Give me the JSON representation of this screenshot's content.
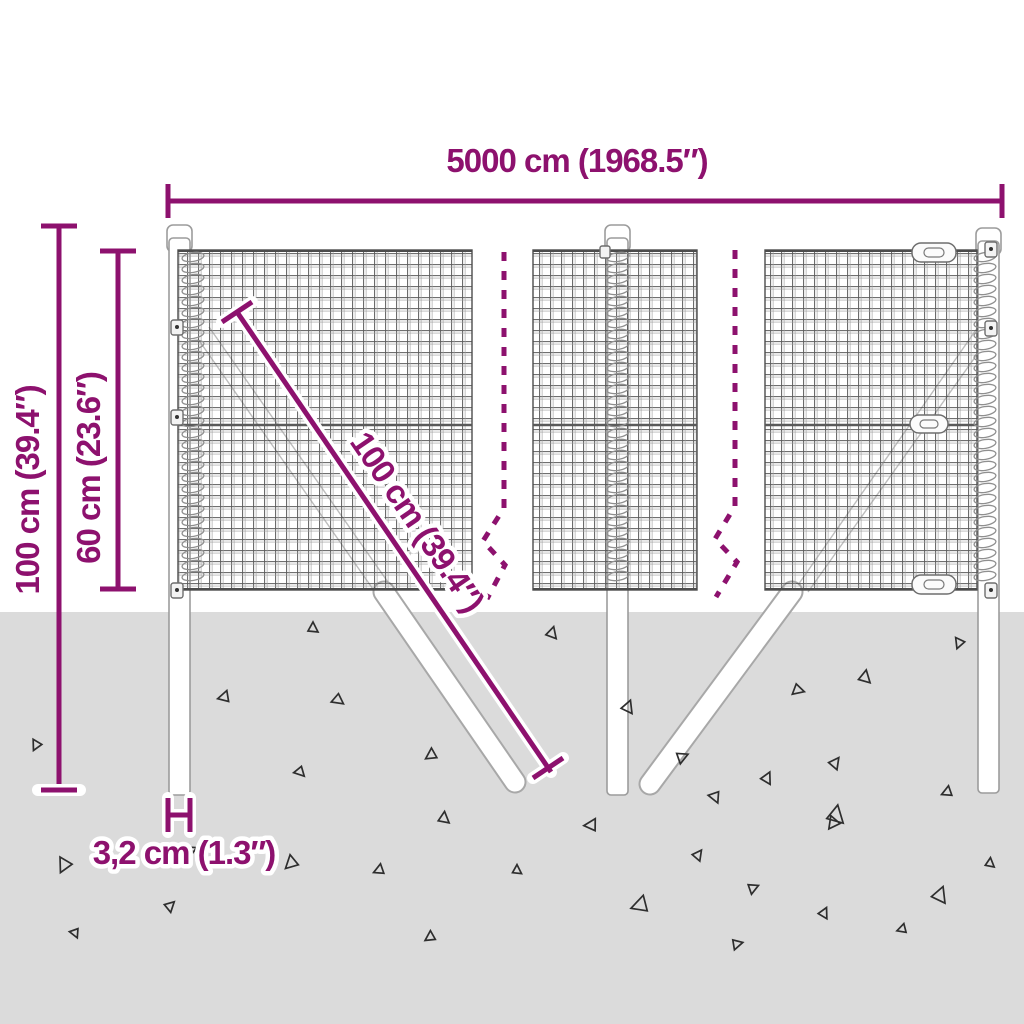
{
  "diagram": {
    "subject": "wire-mesh-fence-with-posts-and-ground-anchors",
    "dimensions": {
      "width": {
        "label": "5000 cm (1968.5″)"
      },
      "total_height": {
        "label": "100 cm (39.4″)"
      },
      "mesh_height": {
        "label": "60 cm (23.6″)"
      },
      "anchor_length": {
        "label": "100 cm (39.4″)"
      },
      "post_width": {
        "label": "3,2 cm (1.3″)"
      }
    }
  },
  "colors": {
    "dimension": "#8d116e",
    "ground": "#dbdbdb",
    "mesh_wire": "#3f3f3f",
    "structure_outline": "#9c9c9c"
  },
  "decor": {
    "triangles": [
      [
        313,
        628,
        10,
        0
      ],
      [
        552,
        633,
        11,
        15
      ],
      [
        959,
        643,
        10,
        200
      ],
      [
        865,
        677,
        12,
        10
      ],
      [
        798,
        690,
        11,
        105
      ],
      [
        628,
        707,
        12,
        20
      ],
      [
        224,
        697,
        11,
        255
      ],
      [
        338,
        700,
        11,
        125
      ],
      [
        36,
        745,
        10,
        205
      ],
      [
        431,
        755,
        11,
        235
      ],
      [
        682,
        757,
        11,
        65
      ],
      [
        300,
        772,
        10,
        135
      ],
      [
        767,
        778,
        11,
        25
      ],
      [
        835,
        763,
        11,
        35
      ],
      [
        947,
        792,
        10,
        245
      ],
      [
        715,
        797,
        11,
        155
      ],
      [
        836,
        815,
        17,
        10
      ],
      [
        444,
        818,
        11,
        5
      ],
      [
        591,
        825,
        12,
        265
      ],
      [
        64,
        865,
        14,
        205
      ],
      [
        291,
        863,
        13,
        225
      ],
      [
        170,
        906,
        10,
        45
      ],
      [
        75,
        933,
        9,
        155
      ],
      [
        379,
        870,
        10,
        245
      ],
      [
        430,
        937,
        10,
        235
      ],
      [
        517,
        870,
        9,
        0
      ],
      [
        640,
        905,
        16,
        250
      ],
      [
        698,
        855,
        10,
        35
      ],
      [
        753,
        888,
        10,
        65
      ],
      [
        824,
        913,
        10,
        25
      ],
      [
        902,
        929,
        9,
        250
      ],
      [
        940,
        895,
        15,
        20
      ],
      [
        990,
        863,
        9,
        5
      ],
      [
        737,
        944,
        10,
        75
      ],
      [
        833,
        823,
        12,
        215
      ],
      [
        193,
        849,
        6,
        300
      ]
    ],
    "coils": [
      {
        "x": 193,
        "y1": 257,
        "y2": 584
      },
      {
        "x": 618,
        "y1": 257,
        "y2": 584
      },
      {
        "x": 985,
        "y1": 257,
        "y2": 584
      }
    ]
  }
}
